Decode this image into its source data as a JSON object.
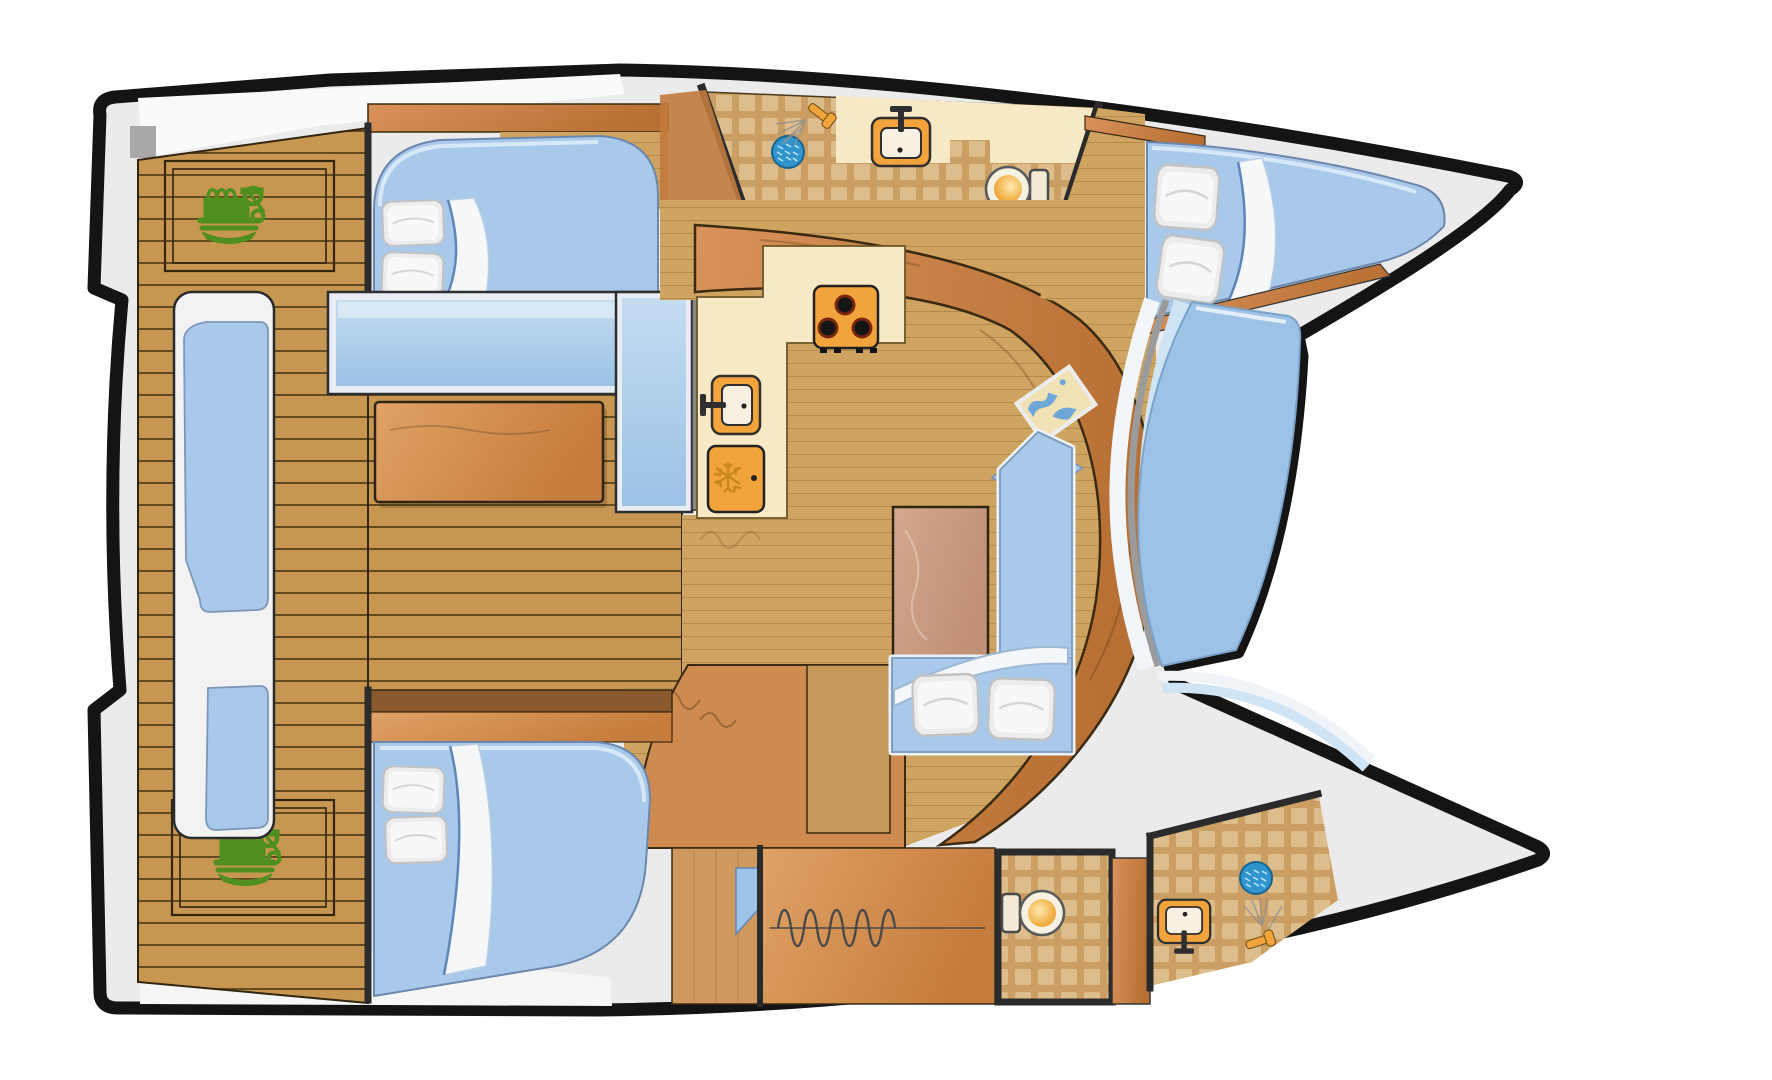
{
  "diagram": {
    "type": "yacht-floor-plan",
    "vessel": "catamaran",
    "view": "top-down interior deck plan",
    "rooms": [
      {
        "id": "aft-deck",
        "label": "Aft cockpit deck (teak planking)"
      },
      {
        "id": "port-engine-hatch",
        "label": "Engine compartment hatch (top-left)"
      },
      {
        "id": "starboard-engine-hatch",
        "label": "Engine compartment hatch (bottom-left)"
      },
      {
        "id": "stern-bench",
        "label": "Stern bench seat with cushions"
      },
      {
        "id": "cockpit-table",
        "label": "Cockpit table"
      },
      {
        "id": "port-aft-cabin",
        "label": "Double cabin with berth (top-left hull)"
      },
      {
        "id": "starboard-aft-cabin",
        "label": "Double cabin with berth (bottom-left hull)"
      },
      {
        "id": "port-head",
        "label": "Bathroom with shower, sink and toilet (top hull)"
      },
      {
        "id": "galley",
        "label": "Galley with stove, sink and refrigerator"
      },
      {
        "id": "salon",
        "label": "Salon with table and L-sofa"
      },
      {
        "id": "nav-station",
        "label": "Navigation desk with chart"
      },
      {
        "id": "bow-cabin",
        "label": "Forward double cabin (top hull bow)"
      },
      {
        "id": "corridor",
        "label": "Companionway and lockers (bottom hull)"
      },
      {
        "id": "starboard-aft-head",
        "label": "Toilet room (bottom hull)"
      },
      {
        "id": "starboard-fwd-head",
        "label": "Bathroom with sink and shower (bottom hull bow)"
      },
      {
        "id": "forward-cockpit",
        "label": "Forward cockpit / trampoline between bows"
      },
      {
        "id": "swim-platforms",
        "label": "Stern swim platforms"
      }
    ],
    "fixtures": [
      {
        "id": "engine-icon",
        "count": 2,
        "icon": "engine-icon"
      },
      {
        "id": "stove",
        "burners": 3,
        "icon": "stove-icon"
      },
      {
        "id": "galley-sink",
        "icon": "sink-icon"
      },
      {
        "id": "refrigerator",
        "icon": "fridge-snowflake-icon"
      },
      {
        "id": "bathroom-sink",
        "count": 2,
        "icon": "sink-icon"
      },
      {
        "id": "toilet",
        "count": 2,
        "icon": "toilet-icon"
      },
      {
        "id": "shower-drain",
        "count": 2,
        "icon": "shower-drain-icon"
      },
      {
        "id": "shower-head",
        "count": 2,
        "icon": "shower-head-icon"
      },
      {
        "id": "double-berth",
        "count": 3,
        "icon": "bed-icon"
      },
      {
        "id": "pillow",
        "count": 8,
        "icon": "pillow-icon"
      },
      {
        "id": "salon-table",
        "icon": "table-icon"
      },
      {
        "id": "sofa",
        "icon": "sofa-icon"
      },
      {
        "id": "nav-chart",
        "icon": "map-icon"
      }
    ]
  },
  "palette": {
    "outline": "#141414",
    "deck_gray": "#ebebeb",
    "teak": "#c79752",
    "plank_line": "#513c18",
    "sole": "#cfa461",
    "tile_base": "#cb9f63",
    "tile_square": "#debd8c",
    "counter_cream": "#f7e9c5",
    "appliance_orange": "#f2a33b",
    "wood_dark": "#b36b33",
    "wood_mid": "#cf8a4f",
    "table_wood": "#cfa184",
    "cushion_blue": "#a9c9ea",
    "cushion_edge": "#e8f2f8",
    "glass_blue": "#9cc2e6",
    "pillow_white": "#f3f3f3",
    "engine_green": "#4f8f1f",
    "drain_blue": "#2f95cc",
    "gold": "#e8920a"
  }
}
